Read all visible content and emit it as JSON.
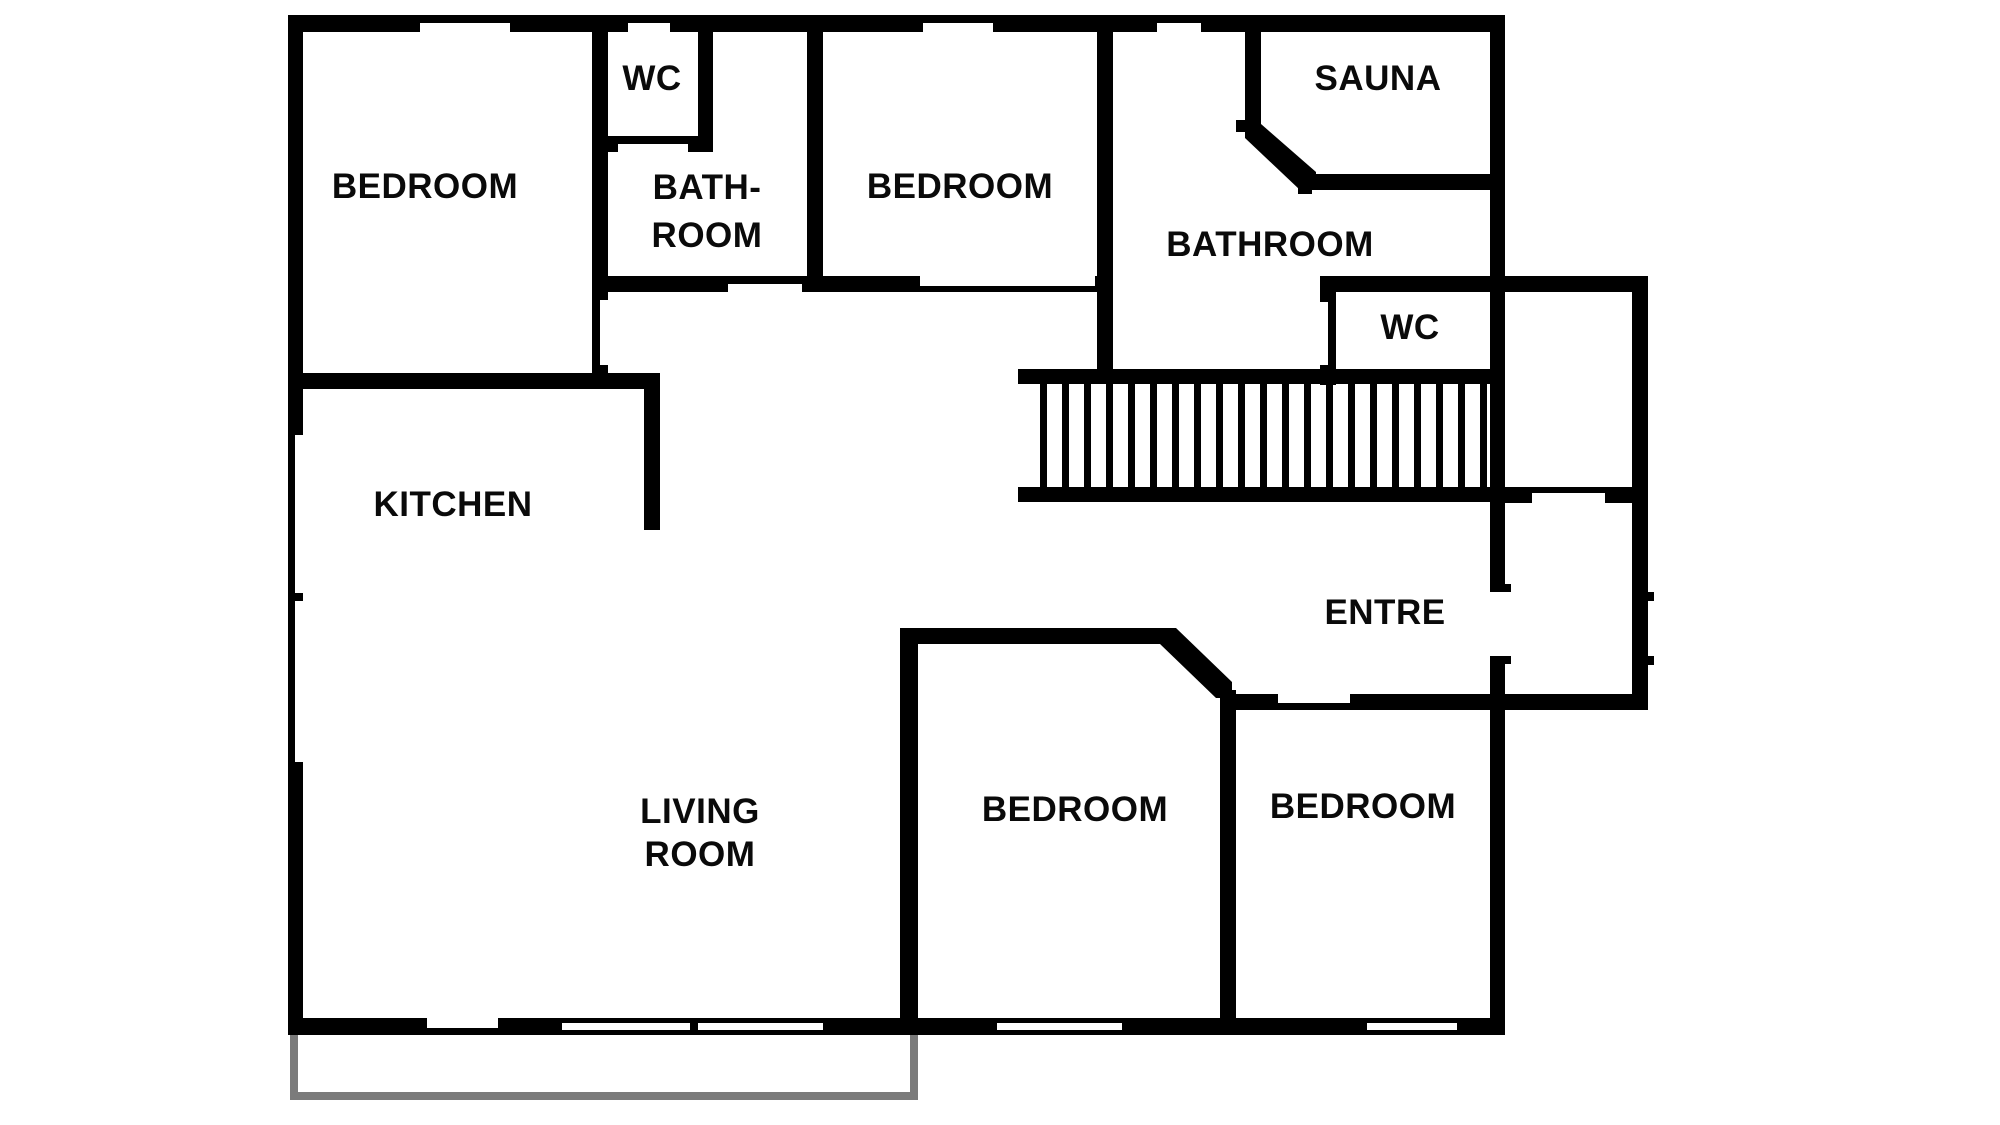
{
  "floorplan": {
    "type": "floor-plan",
    "labels": [
      {
        "id": "bedroom-top-left",
        "text": "BEDROOM"
      },
      {
        "id": "wc-top",
        "text": "WC"
      },
      {
        "id": "bathroom-top-line1",
        "text": "BATH-"
      },
      {
        "id": "bathroom-top-line2",
        "text": "ROOM"
      },
      {
        "id": "bedroom-top-middle",
        "text": "BEDROOM"
      },
      {
        "id": "sauna",
        "text": "SAUNA"
      },
      {
        "id": "bathroom-right",
        "text": "BATHROOM"
      },
      {
        "id": "wc-right",
        "text": "WC"
      },
      {
        "id": "kitchen",
        "text": "KITCHEN"
      },
      {
        "id": "living-room-line1",
        "text": "LIVING"
      },
      {
        "id": "living-room-line2",
        "text": "ROOM"
      },
      {
        "id": "bedroom-bottom-middle",
        "text": "BEDROOM"
      },
      {
        "id": "bedroom-bottom-right",
        "text": "BEDROOM"
      },
      {
        "id": "entre",
        "text": "ENTRE"
      }
    ],
    "colors": {
      "wall": "#000000",
      "terrace": "#7b7b7b",
      "background": "#ffffff",
      "text": "#0a0a0a"
    }
  }
}
